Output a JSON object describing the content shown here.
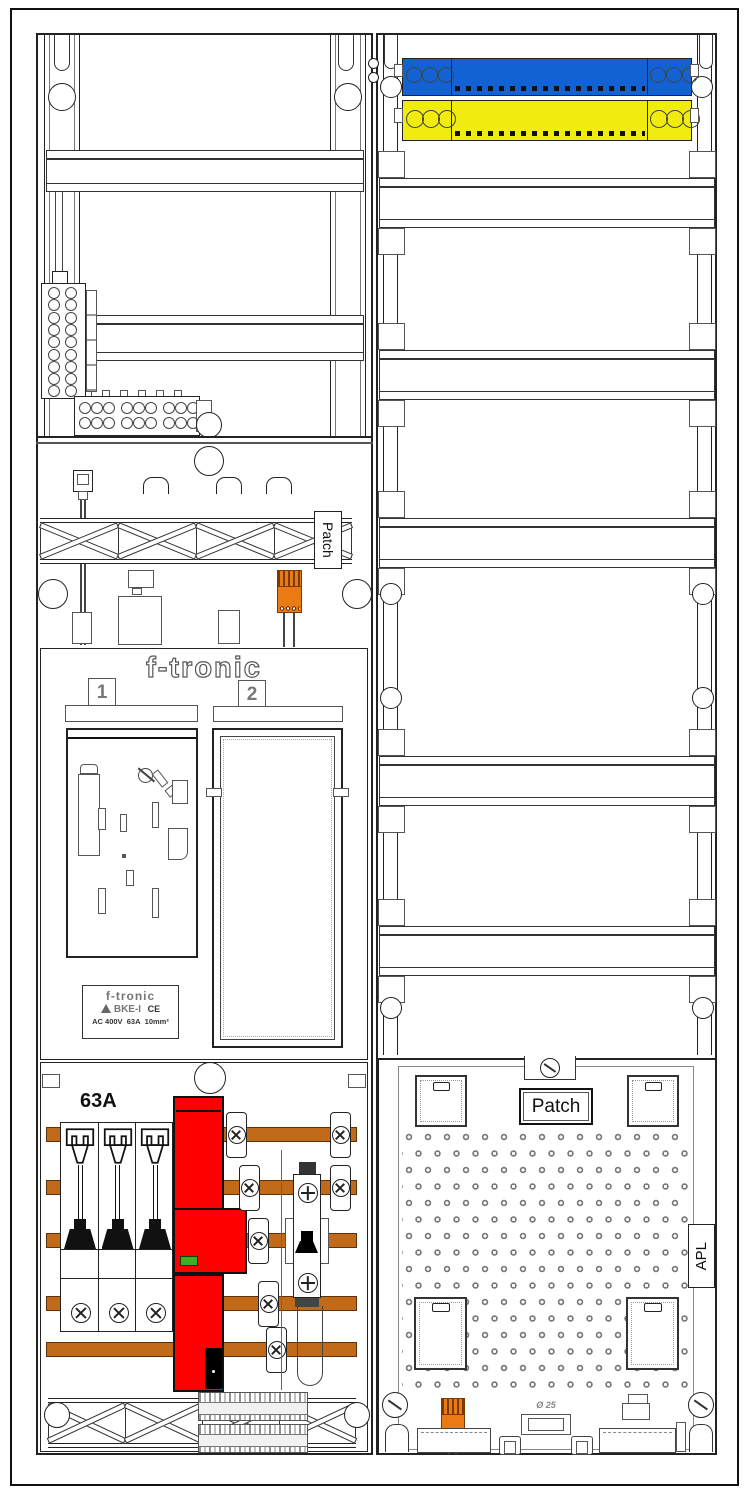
{
  "cabinet": {
    "type_labels": {
      "patch_left": "Patch",
      "patch_right": "Patch",
      "apl": "APL",
      "main_rating": "63A",
      "knockout": "Ø 25"
    },
    "meter_section": {
      "brand_logo": "f-tronic",
      "field_1": "1",
      "field_2": "2"
    },
    "nameplate": {
      "brand": "f-tronic",
      "model": "BKE-I",
      "ce_mark": "CE",
      "voltage": "AC 400V",
      "current": "63A",
      "cross_section": "10mm²"
    },
    "colors": {
      "neutral_busbar": "#1262d4",
      "earth_busbar": "#f0ec10",
      "copper_busbar": "#c06a1a",
      "sls_switch": "#fe0000",
      "status_led": "#3fae20",
      "wago_connector": "#e97a14"
    }
  }
}
